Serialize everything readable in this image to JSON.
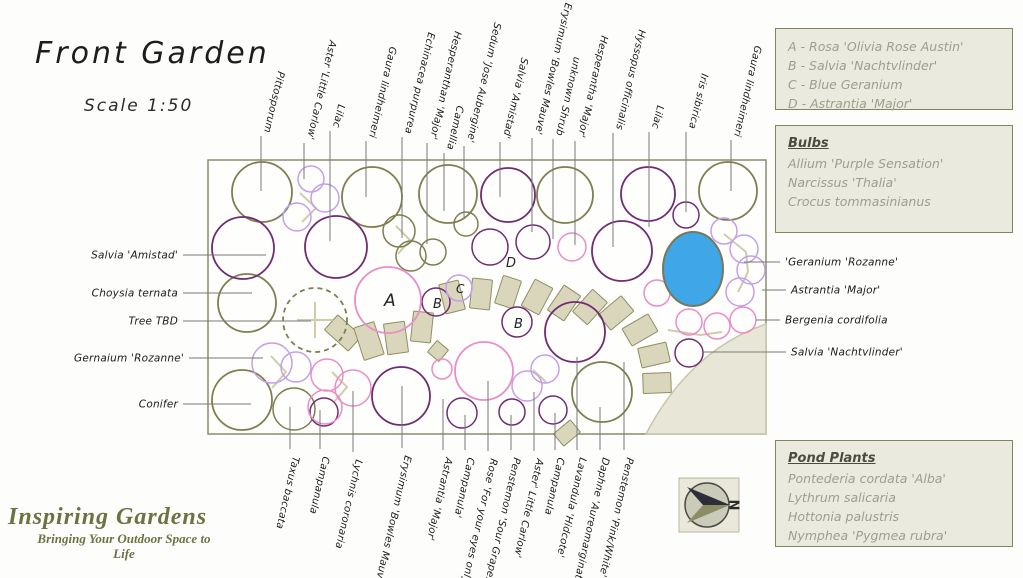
{
  "title": "Front Garden",
  "scale_label": "Scale 1:50",
  "plant_key": {
    "items": [
      "A - Rosa 'Olivia Rose Austin'",
      "B - Salvia 'Nachtvlinder'",
      "C - Blue Geranium",
      "D - Astrantia 'Major'"
    ]
  },
  "bulbs": {
    "title": "Bulbs",
    "items": [
      "Allium 'Purple Sensation'",
      "Narcissus 'Thalia'",
      "Crocus tommasinianus"
    ]
  },
  "pond_plants": {
    "title": "Pond Plants",
    "items": [
      "Pontederia cordata 'Alba'",
      "Lythrum salicaria",
      "Hottonia palustris",
      "Nymphea 'Pygmea rubra'"
    ]
  },
  "branding": {
    "name": "Inspiring Gardens",
    "tagline_line1": "Bringing Your Outdoor Space to",
    "tagline_line2": "Life"
  },
  "compass": {
    "label": "N"
  },
  "colors": {
    "olive": "#7e7e50",
    "purple": "#6f2c72",
    "pink": "#ec8cc7",
    "lilac": "#c49fe9",
    "stone_fill": "#d9d6bc",
    "stone_stroke": "#8f8f63",
    "pond_fill": "#3fa6e8",
    "pond_stroke": "#77775a",
    "patio_fill": "#e8e6d7",
    "patio_stroke": "#c8c6ab",
    "leader_line": "#787878",
    "pale_mark": "#cfccac",
    "label_text": "#1b1b1b"
  },
  "plan": {
    "border": {
      "x": 208,
      "y": 160,
      "w": 558,
      "h": 274
    },
    "pond": {
      "x": 693,
      "y": 269,
      "rx": 30,
      "ry": 37
    },
    "patio_path": "M 766 324 Q 690 350 646 434 L 766 434 Z",
    "labels_top": [
      {
        "x": 261,
        "y1": 136,
        "y2": 191,
        "text": "Pittosporum"
      },
      {
        "x": 304,
        "y1": 143,
        "y2": 179,
        "text": "Aster 'Little Carlow'"
      },
      {
        "x": 330,
        "y1": 131,
        "y2": 241,
        "text": "Lilac"
      },
      {
        "x": 366,
        "y1": 141,
        "y2": 197,
        "text": "Gaura lindheimeri"
      },
      {
        "x": 402,
        "y1": 137,
        "y2": 238,
        "text": "Echinacea purpurea"
      },
      {
        "x": 427,
        "y1": 143,
        "y2": 244,
        "text": "Hesperanthan 'Major'"
      },
      {
        "x": 444,
        "y1": 153,
        "y2": 211,
        "text": "Camellia"
      },
      {
        "x": 464,
        "y1": 146,
        "y2": 219,
        "text": "Sedum 'Jose Aubergine'"
      },
      {
        "x": 500,
        "y1": 142,
        "y2": 197,
        "text": "Salvia 'Amistad'"
      },
      {
        "x": 532,
        "y1": 138,
        "y2": 232,
        "text": "Erysimum 'Bowles Mauve'"
      },
      {
        "x": 553,
        "y1": 139,
        "y2": 239,
        "text": "unknown Shrub"
      },
      {
        "x": 575,
        "y1": 141,
        "y2": 245,
        "text": "Hesperantha 'Major'"
      },
      {
        "x": 613,
        "y1": 133,
        "y2": 247,
        "text": "Hyssopus officinalis"
      },
      {
        "x": 649,
        "y1": 132,
        "y2": 227,
        "text": "Lilac"
      },
      {
        "x": 686,
        "y1": 132,
        "y2": 212,
        "text": "Iris sibirica"
      },
      {
        "x": 731,
        "y1": 140,
        "y2": 191,
        "text": "Gaura lindheimeri"
      }
    ],
    "labels_bottom": [
      {
        "x": 290,
        "y1": 407,
        "y2": 449,
        "text": "Taxus baccata"
      },
      {
        "x": 320,
        "y1": 410,
        "y2": 449,
        "text": "Campanula"
      },
      {
        "x": 353,
        "y1": 391,
        "y2": 452,
        "text": "Lychnis coronaria"
      },
      {
        "x": 402,
        "y1": 386,
        "y2": 448,
        "text": "Erysimum 'Bowles Mauve'"
      },
      {
        "x": 443,
        "y1": 399,
        "y2": 450,
        "text": "Astrantia 'Major'"
      },
      {
        "x": 465,
        "y1": 415,
        "y2": 450,
        "text": "Campanula'"
      },
      {
        "x": 488,
        "y1": 381,
        "y2": 451,
        "text": "Rose 'For your eyes only'"
      },
      {
        "x": 511,
        "y1": 415,
        "y2": 450,
        "text": "Penstemon 'Sour Grapes'"
      },
      {
        "x": 534,
        "y1": 392,
        "y2": 451,
        "text": "Aster' Little Carlow'"
      },
      {
        "x": 555,
        "y1": 413,
        "y2": 450,
        "text": "Campanula"
      },
      {
        "x": 577,
        "y1": 357,
        "y2": 450,
        "text": "Lavandula 'Hidcote'"
      },
      {
        "x": 600,
        "y1": 407,
        "y2": 450,
        "text": "Daphne 'Aureomarginata'"
      },
      {
        "x": 624,
        "y1": 362,
        "y2": 450,
        "text": "Penstemon 'Pink/White'"
      }
    ],
    "labels_left": [
      {
        "y": 255,
        "x1": 183,
        "x2": 266,
        "text": "Salvia 'Amistad'"
      },
      {
        "y": 293,
        "x1": 183,
        "x2": 252,
        "text": "Choysia ternata"
      },
      {
        "y": 321,
        "x1": 183,
        "x2": 311,
        "text": "Tree TBD"
      },
      {
        "y": 358,
        "x1": 189,
        "x2": 263,
        "text": "Gernaium 'Rozanne'"
      },
      {
        "y": 404,
        "x1": 183,
        "x2": 251,
        "text": "Conifer"
      }
    ],
    "labels_right": [
      {
        "y": 262,
        "x1": 744,
        "x2": 780,
        "text": "'Geranium 'Rozanne'"
      },
      {
        "y": 290,
        "x1": 762,
        "x2": 786,
        "text": "Astrantia 'Major'"
      },
      {
        "y": 320,
        "x1": 756,
        "x2": 780,
        "text": "Bergenia cordifolia"
      },
      {
        "y": 352,
        "x1": 702,
        "x2": 786,
        "text": "Salvia 'Nachtvlinder'"
      }
    ],
    "markers": [
      {
        "letter": "A",
        "x": 384,
        "y": 306,
        "fs": 17
      },
      {
        "letter": "B",
        "x": 433,
        "y": 308,
        "fs": 13
      },
      {
        "letter": "C",
        "x": 456,
        "y": 293,
        "fs": 12
      },
      {
        "letter": "D",
        "x": 506,
        "y": 267,
        "fs": 13
      },
      {
        "letter": "B",
        "x": 514,
        "y": 328,
        "fs": 13
      }
    ],
    "circles": [
      [
        262,
        192,
        30,
        "olive"
      ],
      [
        372,
        197,
        30,
        "olive"
      ],
      [
        448,
        194,
        29,
        "olive"
      ],
      [
        565,
        195,
        28,
        "olive"
      ],
      [
        728,
        191,
        29,
        "olive"
      ],
      [
        399,
        231,
        16,
        "olive"
      ],
      [
        411,
        256,
        15,
        "olive"
      ],
      [
        433,
        252,
        13,
        "olive"
      ],
      [
        466,
        224,
        12,
        "olive"
      ],
      [
        247,
        303,
        29,
        "olive"
      ],
      [
        242,
        400,
        30,
        "olive"
      ],
      [
        294,
        409,
        21,
        "olive"
      ],
      [
        602,
        392,
        30,
        "olive"
      ],
      [
        315,
        320,
        32,
        "olive",
        "dashed"
      ],
      [
        243,
        248,
        31,
        "purple"
      ],
      [
        336,
        247,
        31,
        "purple"
      ],
      [
        508,
        195,
        27,
        "purple"
      ],
      [
        648,
        194,
        27,
        "purple"
      ],
      [
        686,
        215,
        13,
        "purple"
      ],
      [
        533,
        242,
        17,
        "purple"
      ],
      [
        490,
        247,
        18,
        "purple"
      ],
      [
        622,
        251,
        30,
        "purple"
      ],
      [
        436,
        302,
        14,
        "purple"
      ],
      [
        517,
        322,
        15,
        "purple"
      ],
      [
        401,
        396,
        29,
        "purple"
      ],
      [
        324,
        412,
        14,
        "purple"
      ],
      [
        462,
        413,
        15,
        "purple"
      ],
      [
        512,
        412,
        13,
        "purple"
      ],
      [
        553,
        410,
        14,
        "purple"
      ],
      [
        575,
        332,
        30,
        "purple"
      ],
      [
        689,
        353,
        14,
        "purple"
      ],
      [
        572,
        247,
        14,
        "pink"
      ],
      [
        388,
        300,
        33,
        "pink"
      ],
      [
        484,
        371,
        29,
        "pink"
      ],
      [
        327,
        375,
        16,
        "pink"
      ],
      [
        353,
        388,
        18,
        "pink"
      ],
      [
        325,
        407,
        17,
        "pink"
      ],
      [
        442,
        369,
        10,
        "pink"
      ],
      [
        657,
        293,
        13,
        "pink"
      ],
      [
        689,
        322,
        13,
        "pink"
      ],
      [
        717,
        326,
        13,
        "pink"
      ],
      [
        743,
        320,
        13,
        "pink"
      ],
      [
        311,
        179,
        13,
        "lilac"
      ],
      [
        325,
        198,
        14,
        "lilac"
      ],
      [
        297,
        217,
        14,
        "lilac"
      ],
      [
        272,
        363,
        20,
        "lilac"
      ],
      [
        296,
        367,
        15,
        "lilac"
      ],
      [
        459,
        288,
        13,
        "lilac"
      ],
      [
        527,
        386,
        15,
        "lilac"
      ],
      [
        545,
        369,
        14,
        "lilac"
      ],
      [
        724,
        231,
        13,
        "lilac"
      ],
      [
        744,
        249,
        14,
        "lilac"
      ],
      [
        751,
        270,
        14,
        "lilac"
      ],
      [
        740,
        292,
        14,
        "lilac"
      ]
    ],
    "stones": [
      [
        343,
        333,
        20,
        32,
        -48
      ],
      [
        369,
        341,
        21,
        34,
        -18
      ],
      [
        396,
        338,
        21,
        31,
        -8
      ],
      [
        422,
        327,
        20,
        30,
        6
      ],
      [
        452,
        297,
        20,
        30,
        -14
      ],
      [
        481,
        294,
        20,
        30,
        6
      ],
      [
        508,
        292,
        19,
        29,
        18
      ],
      [
        537,
        297,
        20,
        30,
        28
      ],
      [
        564,
        303,
        20,
        30,
        34
      ],
      [
        590,
        307,
        20,
        30,
        42
      ],
      [
        616,
        313,
        20,
        30,
        50
      ],
      [
        640,
        330,
        20,
        30,
        60
      ],
      [
        654,
        355,
        20,
        29,
        77
      ],
      [
        657,
        383,
        20,
        28,
        88
      ],
      [
        438,
        351,
        15,
        15,
        40
      ],
      [
        567,
        433,
        16,
        22,
        50
      ]
    ],
    "pale_marks": [
      [
        [
          300,
          193
        ],
        [
          316,
          208
        ],
        [
          302,
          222
        ]
      ],
      [
        [
          396,
          226
        ],
        [
          410,
          240
        ],
        [
          398,
          254
        ]
      ],
      [
        [
          271,
          356
        ],
        [
          286,
          372
        ],
        [
          272,
          388
        ]
      ],
      [
        [
          332,
          372
        ],
        [
          347,
          387
        ],
        [
          334,
          402
        ]
      ],
      [
        [
          533,
          370
        ],
        [
          546,
          382
        ]
      ],
      [
        [
          724,
          234
        ],
        [
          746,
          252
        ],
        [
          748,
          272
        ],
        [
          738,
          292
        ]
      ],
      [
        [
          668,
          330
        ],
        [
          700,
          335
        ],
        [
          722,
          332
        ]
      ],
      [
        [
          315,
          302
        ],
        [
          315,
          338
        ]
      ],
      [
        [
          297,
          320
        ],
        [
          333,
          320
        ]
      ]
    ]
  }
}
